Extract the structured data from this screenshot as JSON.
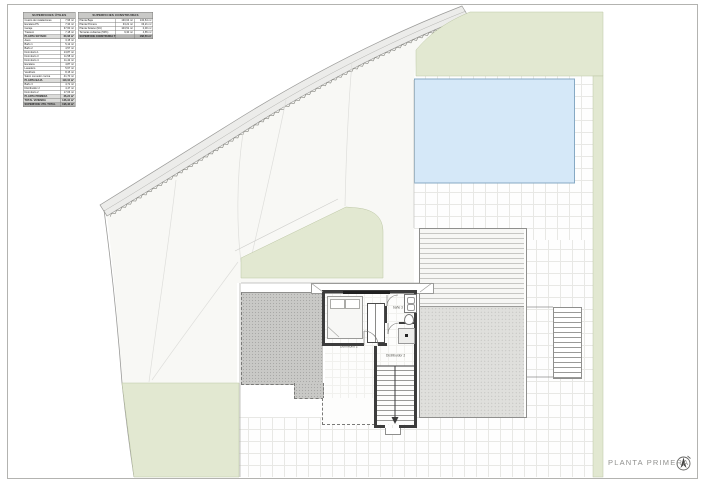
{
  "title": {
    "label": "PLANTA PRIMERA"
  },
  "colors": {
    "green_area": "#e2e8d1",
    "pool_fill": "#d5e8f8",
    "pool_border": "#86a9c4",
    "wall": "#3c3c3c",
    "roadband": "#ececea",
    "title_text": "#90908e"
  },
  "rooms": {
    "bedroom": "Dormitorio 2",
    "bath": "baño 3",
    "hall": "Distribuidor 2"
  },
  "tables": {
    "useful": {
      "header": "SUPERFICIES ÚTILES",
      "rows": [
        [
          "Cuarto de instalaciones",
          "7,96 m²",
          "n"
        ],
        [
          "Escalera PS",
          "7,34 m²",
          "n"
        ],
        [
          "Garaje",
          "37,60 m²",
          "n"
        ],
        [
          "Trastero",
          "7,18 m²",
          "n"
        ],
        [
          "PLANTA SÓTANO",
          "60,08 m²",
          "s"
        ],
        [
          "Aseo",
          "3,15 m²",
          "n"
        ],
        [
          "Baño 1",
          "5,12 m²",
          "n"
        ],
        [
          "Baño 2",
          "4,57 m²",
          "n"
        ],
        [
          "Dormitorio 1",
          "13,87 m²",
          "n"
        ],
        [
          "Dormitorio 3",
          "11,58 m²",
          "n"
        ],
        [
          "Dormitorio 4",
          "11,42 m²",
          "n"
        ],
        [
          "Escalera",
          "4,87 m²",
          "n"
        ],
        [
          "Lavadero",
          "5,67 m²",
          "n"
        ],
        [
          "Vestíbulo",
          "8,15 m²",
          "n"
        ],
        [
          "Salón comedor cocina",
          "41,70 m²",
          "n"
        ],
        [
          "PLANTA BAJA",
          "110,10 m²",
          "s"
        ],
        [
          "Baño 3",
          "4,71 m²",
          "n"
        ],
        [
          "Distribuidor 2",
          "4,47 m²",
          "n"
        ],
        [
          "Dormitorio 2",
          "17,06 m²",
          "n"
        ],
        [
          "PLANTA PRIMERA",
          "26,24 m²",
          "s"
        ],
        [
          "TOTAL VIVIENDA",
          "136,34 m²",
          "s"
        ],
        [
          "SUPERFICIE ÚTIL TOTAL",
          "196,42 m²",
          "t"
        ]
      ]
    },
    "built": {
      "header": "SUPERFICIES CONSTRUIDAS",
      "rows": [
        [
          "Planta Baja",
          "130,64 m²",
          "130,64 m²",
          "n"
        ],
        [
          "Planta Primera",
          "33,21 m²",
          "33,21 m²",
          "n"
        ],
        [
          "Planta Sótano (NC)",
          "103,51 m²",
          "0,00 m²",
          "n"
        ],
        [
          "Terrazas cubiertas (50%)",
          "9,30 m²",
          "4,65 m²",
          "n"
        ],
        [
          "SUPERFICIE CONSTRUIDA TOTAL",
          "",
          "168,50 m²",
          "t"
        ]
      ]
    }
  },
  "icons": {
    "north_arrow": "north-arrow"
  }
}
